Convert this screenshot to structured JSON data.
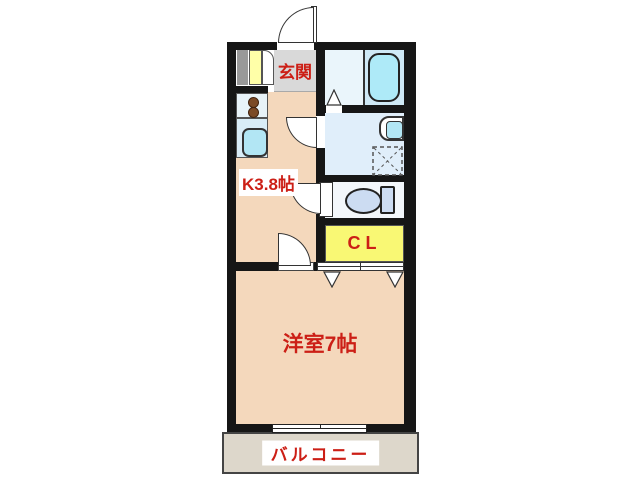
{
  "plan": {
    "labels": {
      "entrance": "玄関",
      "kitchen": "K3.8帖",
      "closet": "CL",
      "main_room": "洋室7帖",
      "balcony": "バルコニー"
    },
    "colors": {
      "wall": "#161616",
      "room_floor": "#f4d8bc",
      "entrance_floor": "#d9d9d9",
      "balcony_floor": "#ddd7cb",
      "bath_floor": "#eaf5fb",
      "washroom_floor": "#e0eefa",
      "toilet_floor": "#f3f7fb",
      "bathtub_fill": "#aeeaf8",
      "fixture_fill": "#b2e6f4",
      "toilet_fill": "#ccdcf2",
      "closet_fill": "#f9f874",
      "label_red": "#cc1f16",
      "cabinet_gray": "#999999",
      "cabinet_yellow": "#ffffa8",
      "burner_brown": "#7b4a26"
    }
  }
}
